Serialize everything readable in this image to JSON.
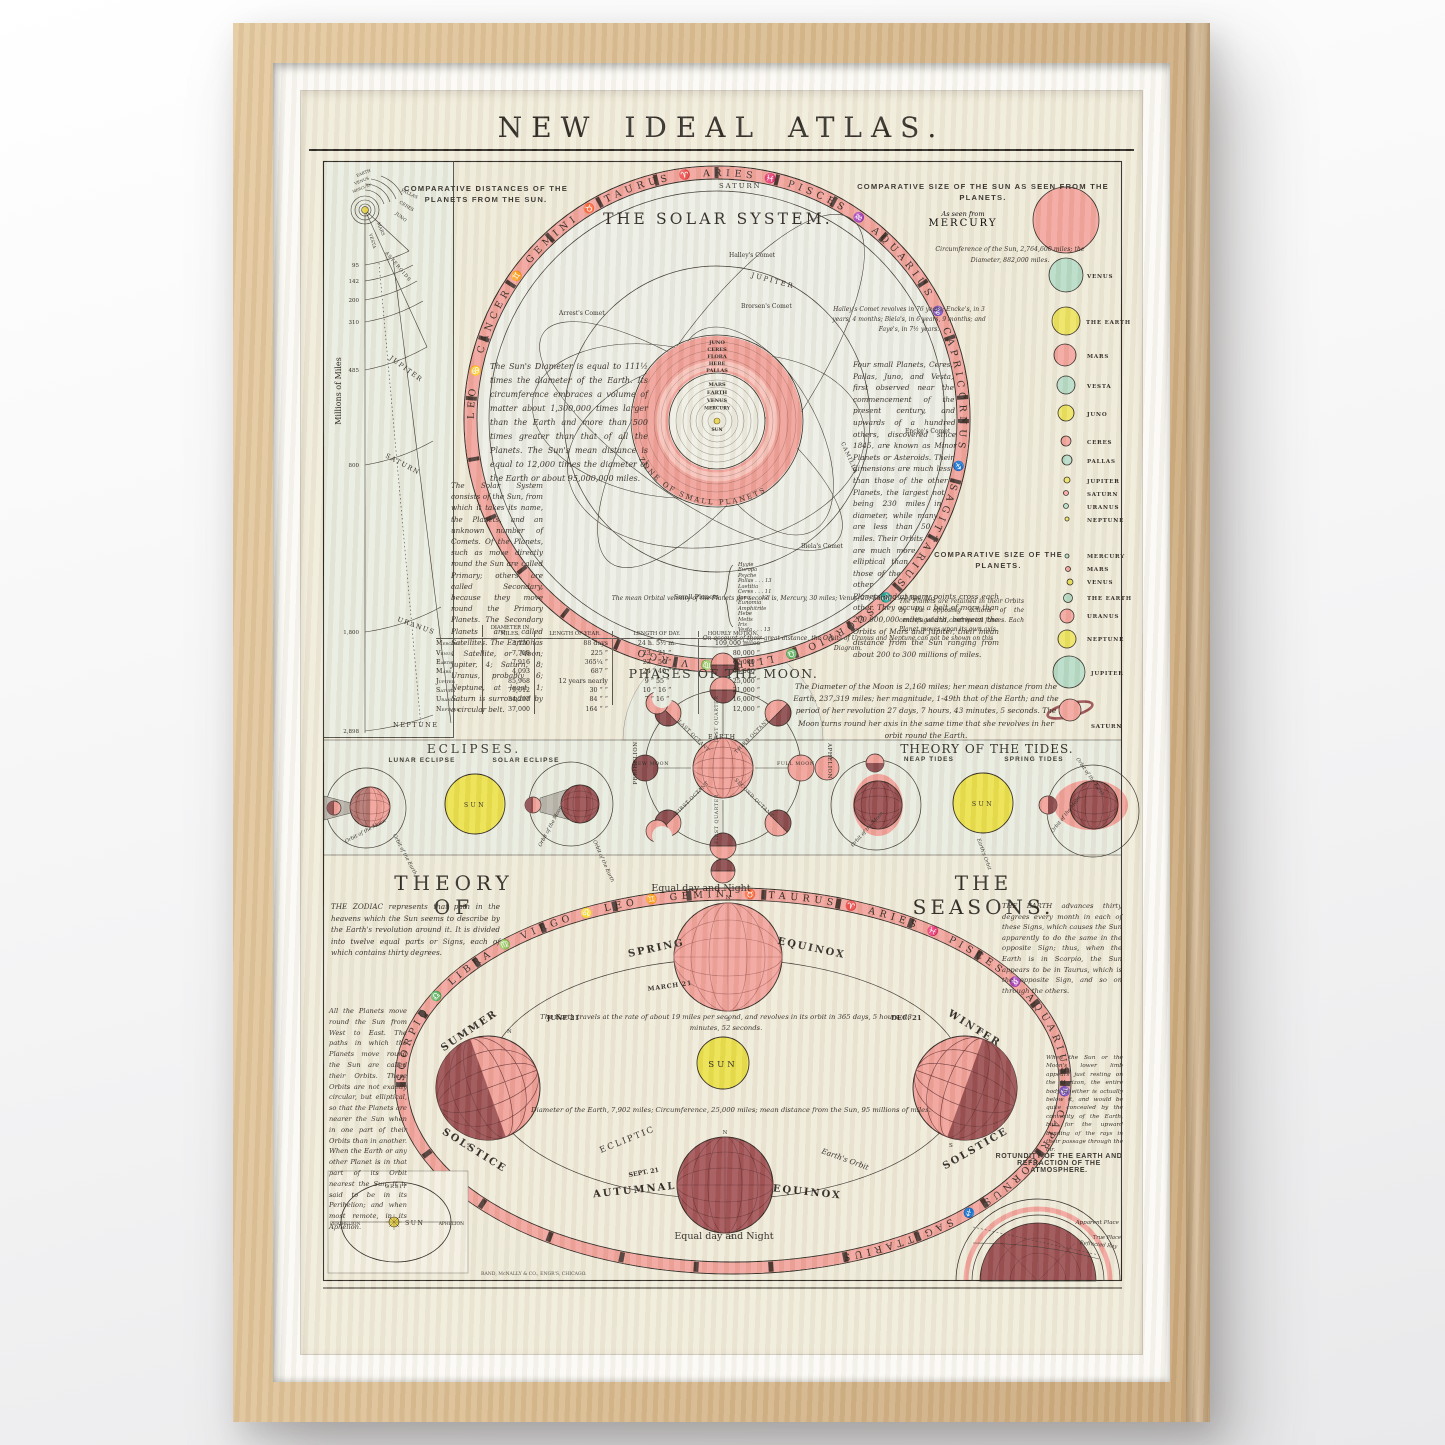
{
  "colors": {
    "paper": "#f1ecdb",
    "panel": "#e9ece0",
    "pink": "#f2a49c",
    "deep_pink": "#ef958d",
    "maroon": "#9a4e50",
    "yellow": "#ebe14c",
    "green": "#b7dcc6",
    "ink": "#2e2924",
    "wood": "#d9bb8f"
  },
  "title": "NEW IDEAL ATLAS.",
  "imprint": "RAND, McNALLY & CO., ENGR'S, CHICAGO.",
  "distances": {
    "heading": "COMPARATIVE DISTANCES OF THE PLANETS FROM THE SUN.",
    "axis": "Millions of Miles",
    "ticks": [
      "95",
      "142",
      "200",
      "310",
      "485",
      "800",
      "1,800",
      "2,898"
    ],
    "sun": "SUN",
    "earth": "EARTH",
    "venus": "VENUS",
    "mercury": "MERCURY",
    "pallas": "PALLAS",
    "ceres": "CERES",
    "juno": "JUNO",
    "mars": "MARS",
    "vesta": "VESTA",
    "belt": "ASTEROIDS",
    "jupiter": "JUPITER",
    "saturn": "SATURN",
    "uranus": "URANUS",
    "neptune": "NEPTUNE"
  },
  "solar_system": {
    "heading": "THE SOLAR SYSTEM.",
    "zodiac": "LEO ♋ CANCER ♊ GEMINI ♉ TAURUS ♈ ARIES ♓ PISCES ♒ AQUARIUS ♑ CAPRICORNUS ♐ SAGITTARIUS ♏ SCORPIO ♎ LIBRA ♍ VIRGO",
    "saturn_orbit": "SATURN",
    "jupiter_orbit": "JUPITER",
    "halley": "Halley's Comet",
    "arrest": "Arrest's Comet",
    "brorsen": "Brorsen's Comet",
    "encke": "Encke's Comet",
    "biela": "Biela's Comet",
    "comet_note": "Halley's Comet revolves in 76 years; Encke's, in 3 years, 4 months; Biela's, in 6 years, 9 months; and Faye's, in 7½ years.",
    "inner_planets": [
      "JUNO",
      "CERES",
      "FLORA",
      "HEBE",
      "PALLAS",
      "MARS",
      "EARTH",
      "VENUS",
      "MERCURY"
    ],
    "sun": "SUN",
    "camilla": "CAMILLA",
    "zone": "ZONE OF SMALL PLANETS",
    "sun_text": "The Sun's Diameter is equal to 111½ times the diameter of the Earth. Its circumference embraces a volume of matter about 1,300,000 times larger than the Earth and more than 500 times greater than that of all the Planets. The Sun's mean distance is equal to 12,000 times the diameter of the Earth or about 95,000,000 miles.",
    "system_text": "The Solar System consists of the Sun, from which it takes its name, the Planets, and an unknown number of Comets. Of the Planets, such as move directly round the Sun are called Primary; others are called Secondary, because they move round the Primary Planets. The Secondary Planets are called Satellites. The Earth has 1 Satellite, or Moon; Jupiter, 4; Saturn, 8; Uranus, probably 6; Neptune, at least 1; Saturn is surrounded by a circular belt.",
    "minor_text": "Four small Planets, Ceres, Pallas, Juno, and Vesta, first observed near the commencement of the present century, and upwards of a hundred others, discovered since 1845, are known as Minor Planets or Asteroids. Their dimensions are much less than those of the other Planets, the largest not being 230 miles in diameter, while many are less than 50 miles. Their Orbits are much more elliptical than those of the other Planets and at many points cross each other. They occupy a belt of more than 200,000,000 miles width, between the Orbits of Mars and Jupiter, their mean distance from the Sun ranging from about 200 to 300 millions of miles.",
    "velocity_text": "The mean Orbital velocity of the Planets per second is, Mercury, 30 miles; Venus, 23; Earth, 19; Mars, 15;",
    "small_planets_label": "Small Planets",
    "small_planets": [
      "Hygie",
      "Europa",
      "Psyche",
      "Pallas . . . 13",
      "Laetitia",
      "Ceres . . . 11",
      "Juno . . . 12",
      "Eunomia",
      "Amphitrite",
      "Hebe",
      "Metis",
      "Iris",
      "Vesta . . . 13"
    ],
    "uranus_note": "On account of their great distance, the Orbits of Uranus and Neptune can not be shown on this Diagram."
  },
  "sun_sizes": {
    "heading": "COMPARATIVE SIZE OF THE SUN AS SEEN FROM THE PLANETS.",
    "as_seen_from": "As seen from",
    "first": "MERCURY",
    "circumference_note": "Circumference of the Sun, 2,764,600 miles; the Diameter, 882,000 miles.",
    "labels": [
      "VENUS",
      "THE EARTH",
      "MARS",
      "VESTA",
      "JUNO",
      "CERES",
      "PALLAS",
      "JUPITER",
      "SATURN",
      "URANUS",
      "NEPTUNE"
    ]
  },
  "planet_sizes": {
    "heading": "COMPARATIVE SIZE OF THE PLANETS.",
    "retained_text": "The Planets are retained in their Orbits by the opposing actions of the centrifugal and centripetal forces. Each Planet moves upon its own axis.",
    "labels": [
      "MERCURY",
      "MARS",
      "VENUS",
      "THE EARTH",
      "URANUS",
      "NEPTUNE",
      "JUPITER",
      "SATURN"
    ]
  },
  "table": {
    "headers": [
      "DIAMETER IN MILES.",
      "LENGTH OF YEAR.",
      "LENGTH OF DAY.",
      "HOURLY MOTION."
    ],
    "rows": [
      {
        "name": "Mercury",
        "diameter": "3,150",
        "year": "88 days",
        "day": "24 h. 5½ m.",
        "motion": "109,000 miles"
      },
      {
        "name": "Venus",
        "diameter": "7,718",
        "year": "225 “",
        "day": "23 “ 21 “",
        "motion": "80,000 “"
      },
      {
        "name": "Earth",
        "diameter": "7,916",
        "year": "365¼ “",
        "day": "23 “ 56 “",
        "motion": "62,000 “"
      },
      {
        "name": "Mars",
        "diameter": "4,093",
        "year": "687 “",
        "day": "24 “ 40 “",
        "motion": "53,000 “"
      },
      {
        "name": "Jupiter",
        "diameter": "85,968",
        "year": "12 years nearly",
        "day": "9 “ 55 “",
        "motion": "25,000 “"
      },
      {
        "name": "Saturn",
        "diameter": "79,012",
        "year": "30 “ “",
        "day": "10 “ 16 “",
        "motion": "21,000 “"
      },
      {
        "name": "Uranus",
        "diameter": "34,297",
        "year": "84 “ “",
        "day": "7 “ 16 “",
        "motion": "16,000 “"
      },
      {
        "name": "Neptune",
        "diameter": "37,000",
        "year": "164 “ “",
        "day": "",
        "motion": "12,000 “"
      }
    ]
  },
  "moon": {
    "heading": "PHASES OF THE MOON.",
    "earth": "EARTH",
    "spokes": [
      "LAST QUARTER",
      "THIRD OCTANT",
      "FULL MOON",
      "SECOND OCTANT",
      "FIRST QUARTER",
      "FIRST OCTANT",
      "NEW MOON",
      "LAST OCTANT"
    ],
    "perihelion": "PERIHELION",
    "aphelion": "APHELION",
    "text": "The Diameter of the Moon is 2,160 miles; her mean distance from the Earth, 237,319 miles; her magnitude, 1-49th that of the Earth; and the period of her revolution 27 days, 7 hours, 43 minutes, 5 seconds. The Moon turns round her axis in the same time that she revolves in her orbit round the Earth."
  },
  "eclipses": {
    "heading": "ECLIPSES.",
    "lunar": "LUNAR ECLIPSE",
    "solar": "SOLAR ECLIPSE",
    "sun": "SUN",
    "orbit_moon": "Orbit of the Moon",
    "orbit_earth": "Orbit of the Earth"
  },
  "tides": {
    "heading": "THEORY OF THE TIDES.",
    "neap": "NEAP TIDES",
    "spring": "SPRING TIDES",
    "sun": "SUN",
    "orbit_moon": "Orbit of the Moon",
    "earths_orbit": "Earth's Orbit",
    "orbit_earth": "Orbit of the Earth"
  },
  "seasons": {
    "heading_left": "THEORY OF",
    "heading_right": "THE SEASONS.",
    "zodiac": "SCORPIO ♎ LIBRA ♍ VIRGO ♌ LEO ♊ GEMINI ♉ TAURUS ♈ ARIES ♓ PISCES ♒ AQUARIUS ♑ CAPRICORNUS ♐ SAGITTARIUS",
    "equal_top": "Equal day and Night",
    "equal_bottom": "Equal day and Night",
    "spring": "SPRING",
    "equinox_spring": "EQUINOX",
    "march": "MARCH 21",
    "summer": "SUMMER",
    "solstice_summer": "SOLSTICE",
    "june": "JUNE 21",
    "winter": "WINTER",
    "solstice_winter": "SOLSTICE",
    "dec": "DEC. 21",
    "autumnal": "AUTUMNAL",
    "equinox_autumn": "EQUINOX",
    "sept": "SEPT. 21",
    "sun": "SUN",
    "ecliptic": "ECLIPTIC",
    "earths_orbit": "Earth's Orbit",
    "n": "N",
    "s": "S",
    "zodiac_text": "THE ZODIAC represents that path in the heavens which the Sun seems to describe by the Earth's revolution around it. It is divided into twelve equal parts or Signs, each of which contains thirty degrees.",
    "earth_text": "THE EARTH advances thirty degrees every month in each of these Signs, which causes the Sun apparently to do the same in the opposite Sign; thus, when the Earth is in Scorpio, the Sun appears to be in Taurus, which is the opposite Sign, and so on through the others.",
    "planets_text": "All the Planets move round the Sun from West to East. The paths in which the Planets move round the Sun are called their Orbits. These Orbits are not exactly circular, but elliptical, so that the Planets are nearer the Sun when in one part of their Orbits than in another. When the Earth or any other Planet is in that part of its Orbit nearest the Sun, it is said to be in its Perihelion; and when most remote, in its Aphelion.",
    "travel_text": "The Earth travels at the rate of about 19 miles per second, and revolves in its orbit in 365 days, 5 hours, 48 minutes, 52 seconds.",
    "diameter_text": "Diameter of the Earth, 7,902 miles; Circumference, 25,000 miles; mean distance from the Sun, 95 millions of miles."
  },
  "orbit_inset": {
    "orbit": "ORBIT",
    "sun": "SUN",
    "perihelion": "PERIHELION",
    "aphelion": "APHELION"
  },
  "rotundity": {
    "heading_1": "ROTUNDITY OF THE EARTH AND",
    "heading_2": "REFRACTION OF THE ATMOSPHERE.",
    "refraction_text": "When the Sun or the Moon's lower limb appears just resting on the Horizon, the entire body of either is actually below it, and would be quite concealed by the convexity of the Earth, but for the upward bending of the rays in their passage through the air.",
    "apparent": "Apparent Place",
    "true_place": "True Place",
    "ray": "Refracted Ray"
  }
}
